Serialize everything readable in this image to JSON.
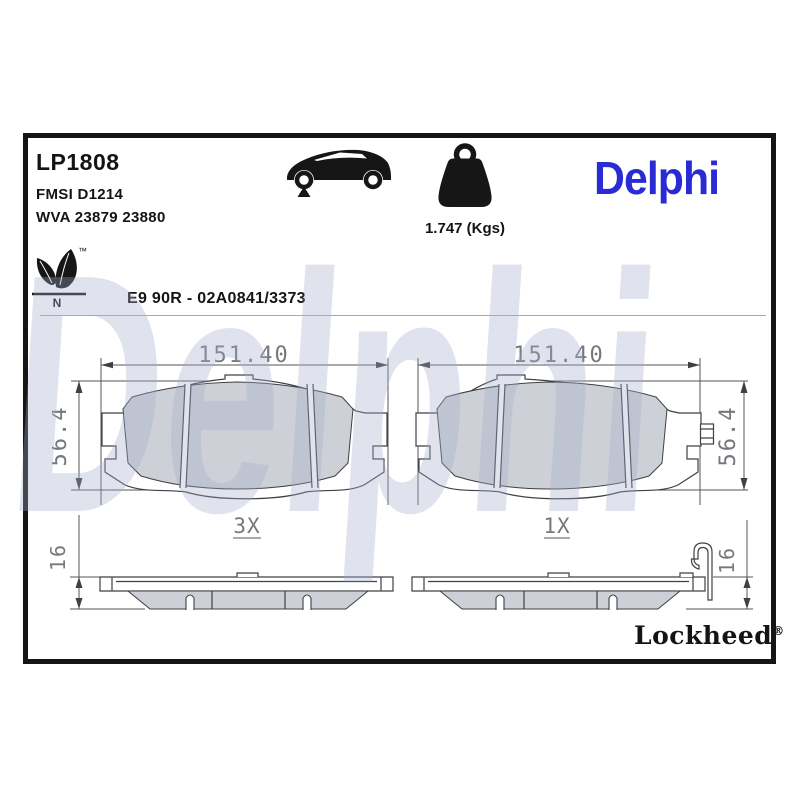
{
  "header": {
    "part_number": "LP1808",
    "fmsi": "FMSI D1214",
    "wva": "WVA 23879 23880",
    "weight": "1.747 (Kgs)",
    "approval": "E9 90R - 02A0841/3373",
    "eco_letter": "N",
    "trademark": "™"
  },
  "branding": {
    "logo_text": "Delphi",
    "logo_color": "#2b2bd6",
    "watermark_text": "Delphi",
    "lockheed_text": "Lockheed",
    "registered": "®"
  },
  "drawing": {
    "front_left": {
      "width": "151.40",
      "height": "56.4",
      "qty": "3X"
    },
    "front_right": {
      "width": "151.40",
      "height": "56.4",
      "qty": "1X"
    },
    "side_left": {
      "thickness": "16"
    },
    "side_right": {
      "thickness": "16"
    },
    "colors": {
      "friction": "#cdd0d6",
      "line": "#3e4043",
      "dim": "#75787d",
      "watermark": "rgba(164,174,202,0.34)"
    }
  },
  "icons": {
    "car": "vehicle-front-axle-icon",
    "weight": "weight-icon",
    "leaf": "eco-leaf-icon"
  }
}
